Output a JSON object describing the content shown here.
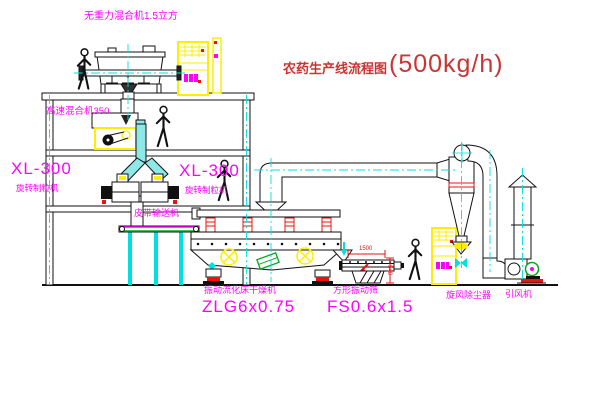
{
  "title": {
    "name": "农药生产线流程图",
    "capacity": "(500kg/h)"
  },
  "labels": {
    "gravity_mixer": "无重力混合机1.5立方",
    "high_speed_mixer": "高速混合机350",
    "xl_left_model": "XL-300",
    "xl_left_name": "旋转制粒机",
    "xl_right_model": "XL-300",
    "xl_right_name": "旋转制粒机",
    "belt_conveyor": "皮带输送机",
    "dryer_name": "振动流化床干燥机",
    "dryer_model": "ZLG6x0.75",
    "screen_name": "方形振动筛",
    "screen_model": "FS0.6x1.5",
    "cyclone": "旋风除尘器",
    "fan": "引风机"
  },
  "dims": {
    "screen_length": "1500",
    "screen_height": "540"
  },
  "colors": {
    "label_magenta": "#ff00ff",
    "title_red": "#cc3333",
    "centerline_cyan": "#00e0e0",
    "highlight_yellow": "#ffee00",
    "accent_red": "#ee1111",
    "conveyor_green": "#00aa22"
  }
}
